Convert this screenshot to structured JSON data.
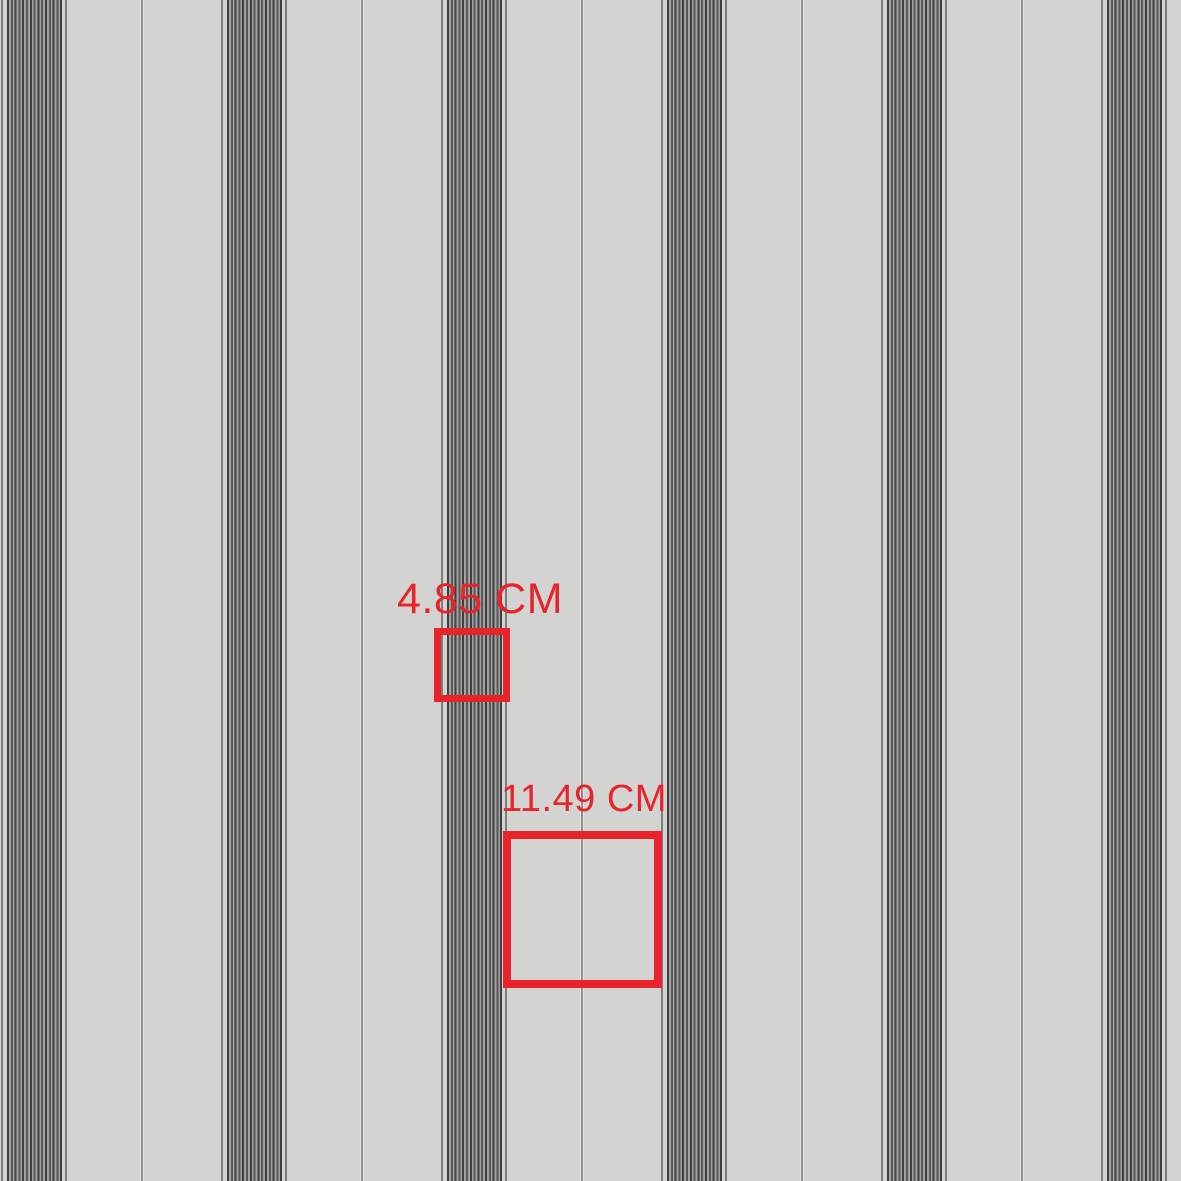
{
  "meta": {
    "description": "Striped pattern swatch preview with red scale-measurement squares",
    "canvas_width": 1181,
    "canvas_height": 1181
  },
  "colors": {
    "background": "#d3d3d1",
    "stripe_dark1": "#3f3f3f",
    "stripe_dark2": "#585858",
    "stripe_light": "#a2a2a2",
    "edge_line": "#7c7c7c",
    "mid_line": "#8f8f8f",
    "accent_red": "#e8242a"
  },
  "pattern": {
    "type": "vertical-pinstripe-bands",
    "group_xs": [
      1,
      221,
      441,
      661,
      881,
      1101
    ],
    "group_width": 66,
    "edge_line_width": 2,
    "band_offset": 6,
    "band_width": 55,
    "midline_xs": [
      141,
      361,
      581,
      801,
      1021
    ],
    "midline_width": 2
  },
  "measurements": {
    "small": {
      "label": "4.85 CM",
      "box": {
        "left": 434,
        "top": 628,
        "width": 76,
        "height": 74,
        "border": 7
      },
      "label_pos": {
        "left": 397,
        "top": 578,
        "font_size": 43
      }
    },
    "large": {
      "label": "11.49 CM",
      "box": {
        "left": 503,
        "top": 831,
        "width": 159,
        "height": 157,
        "border": 8
      },
      "label_pos": {
        "left": 501,
        "top": 780,
        "font_size": 38
      }
    }
  }
}
